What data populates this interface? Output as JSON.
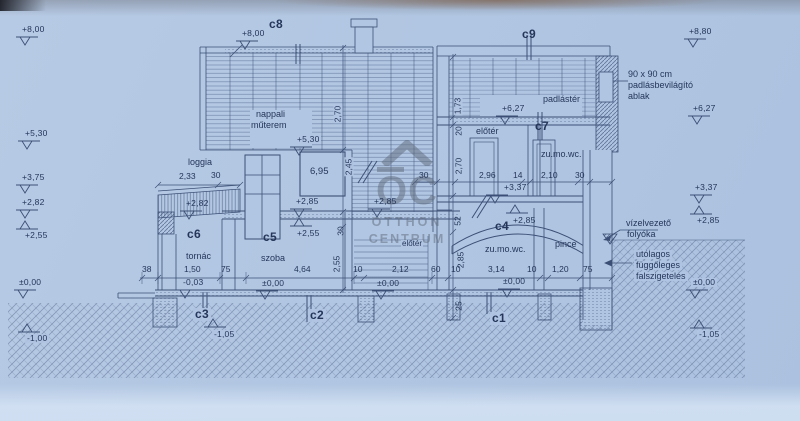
{
  "levels": {
    "left": [
      "+8,00",
      "+5,30",
      "+3,75",
      "+2,82",
      "+2,55",
      "±0,00",
      "-1,00"
    ],
    "right": [
      "+8,80",
      "+6,27",
      "+3,37",
      "+2,85",
      "±0,00",
      "-1,05"
    ],
    "inline": [
      "+8,00",
      "+5,30",
      "+6,27",
      "+3,37",
      "+2,82",
      "+2,85",
      "+2,85",
      "+2,55",
      "+2,85",
      "±0,00",
      "±0,00",
      "±0,00",
      "-0,03",
      "-1,05"
    ]
  },
  "sections": [
    "c1",
    "c2",
    "c3",
    "c4",
    "c5",
    "c6",
    "c7",
    "c8",
    "c9"
  ],
  "rooms": {
    "nappali1": "nappali",
    "nappali2": "műterem",
    "loggia": "loggia",
    "tornac": "tornác",
    "szoba": "szoba",
    "eloter_upper": "előtér",
    "zumowc_upper": "zu.mo.wc.",
    "padlaster": "padlástér",
    "eloter_ground": "előtér",
    "zumowc_lower": "zu.mo.wc.",
    "pince": "pince"
  },
  "annotations": {
    "attic_window": [
      "90 x 90 cm",
      "padlásbevilágító",
      "ablak"
    ],
    "drain": [
      "vízelvezető",
      "folyóka"
    ],
    "wall_insulation": [
      "utólagos",
      "függőleges",
      "falszigetelés"
    ]
  },
  "dimensions": {
    "ground_chain": [
      "38",
      "1,50",
      "75",
      "4,64",
      "10",
      "2,12",
      "60",
      "10",
      "3,14",
      "10",
      "1,20",
      "75"
    ],
    "upper_chain": [
      "30",
      "2,96",
      "14",
      "2,10",
      "30"
    ],
    "loggia_chain": [
      "2,33",
      "30"
    ],
    "vertical_left": [
      "2,70",
      "2,45",
      "30",
      "2,55"
    ],
    "vertical_right": [
      "1,73",
      "20",
      "2,70",
      "52",
      "2,85",
      "25"
    ],
    "skylight": "6,95"
  },
  "watermark": {
    "logo": "OC",
    "line1": "OTTHON",
    "line2": "CENTRUM"
  },
  "colors": {
    "paper": "#b1c6e2",
    "ink": "#2e4166",
    "watermark": "#5f6b7c"
  }
}
